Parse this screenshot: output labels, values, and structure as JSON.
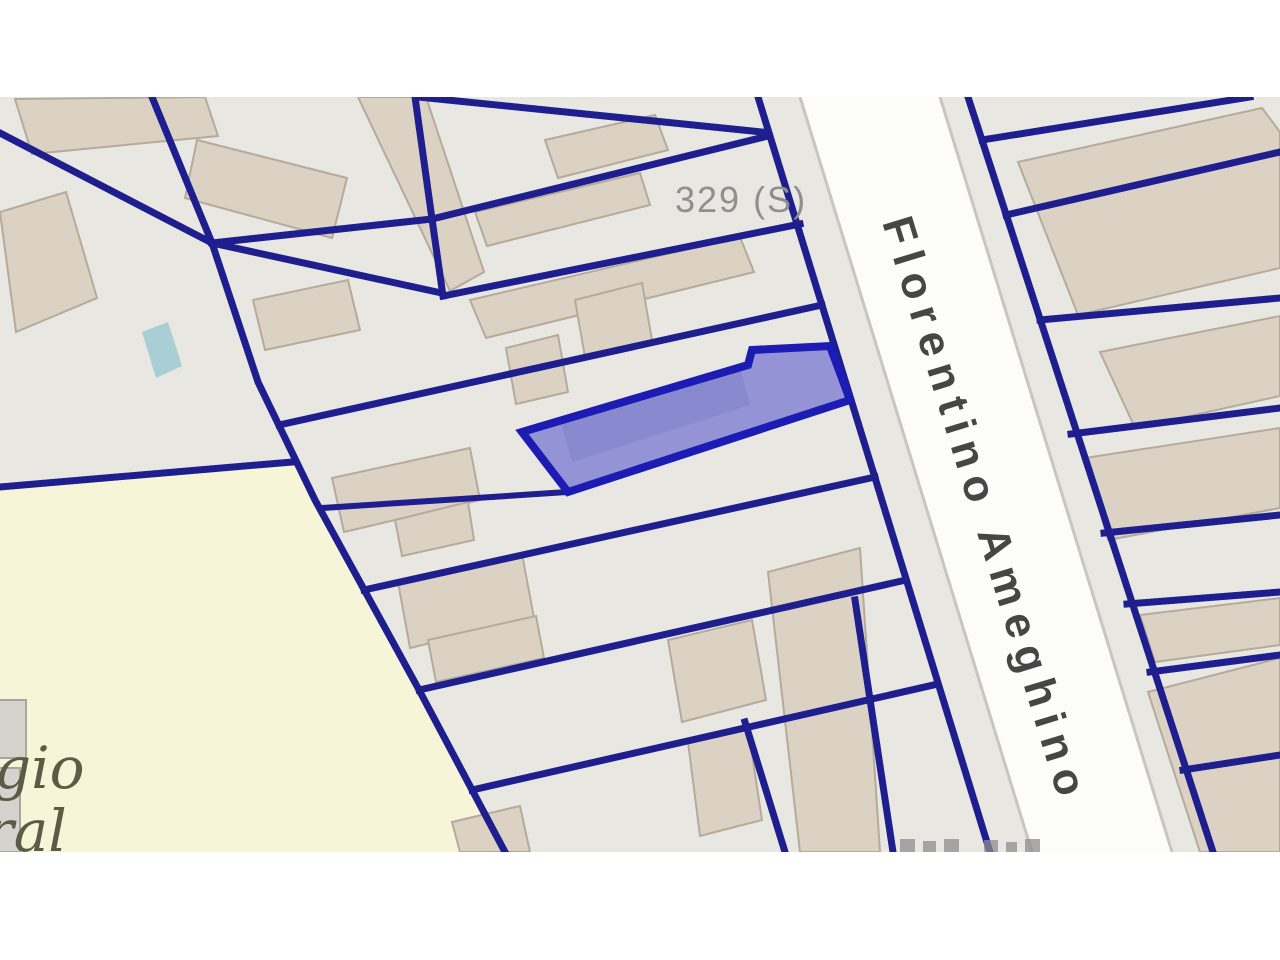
{
  "map": {
    "parcel_label": "329 (S)",
    "street_label": "Florentino Ameghino",
    "landmark_label_line1": "gio",
    "landmark_label_line2": "ral",
    "highlighted_parcel": {
      "status": "selected",
      "fill": "#9393d6",
      "border": "#1c1cb4"
    },
    "colors": {
      "background": "#e9e7e2",
      "parcel_line": "#1e1e8f",
      "street_fill": "#fcfcf9",
      "street_casing": "#c9c6c0",
      "building_fill": "#dcd2c4",
      "building_outline": "#b5ab9d",
      "landmark_fill": "#f7f5d8",
      "water_fill": "#a9cfd5",
      "parcel_label_color": "#8f8f8f",
      "street_label_color": "#464646",
      "landmark_label_color": "#5c5b45",
      "page_margin": "#ffffff"
    }
  }
}
